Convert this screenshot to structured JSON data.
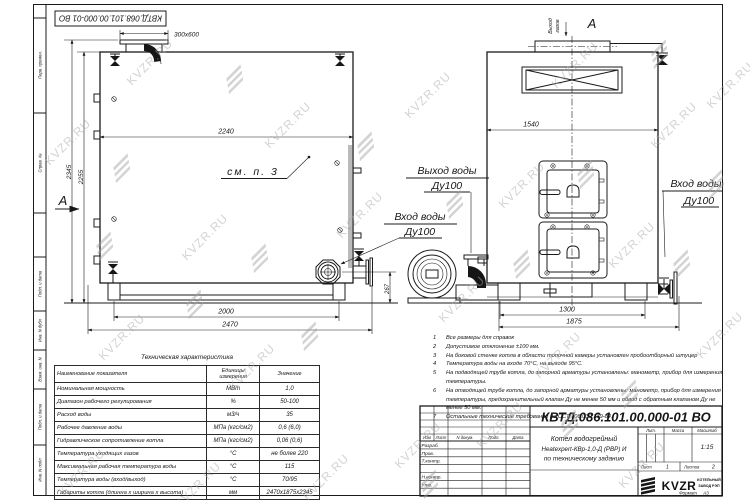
{
  "watermark": {
    "text": "KVZR.RU"
  },
  "stamp_top": "КВТД.068.101.00.000-01 ВО",
  "colors": {
    "line": "#1b1b1b",
    "watermark": "#a9a9a9"
  },
  "frame_labels": {
    "perv_primen": "Перв. примен.",
    "sprav_no": "Справ. №",
    "podp_data1": "Подп. и дата",
    "inv_dubl": "Инв. N дубл",
    "vzam_inv": "Взам. инв. N",
    "podp_data2": "Подп. и дата",
    "inv_podl": "Инв. N подл"
  },
  "side_view": {
    "chimney_size": "300x600",
    "dim_width_top": "2240",
    "dim_height_total": "2345",
    "dim_height_body": "2255",
    "dim_base": "2000",
    "dim_overall": "2470",
    "dim_flange_height": "267",
    "see_note": "см. п. 3",
    "section_mark": "А"
  },
  "front_view": {
    "dim_width": "1540",
    "dim_base": "1300",
    "dim_overall": "1875",
    "gas_out_word1": "Выход",
    "gas_out_word2": "газов",
    "view_mark": "А"
  },
  "labels": {
    "water_out": "Выход воды",
    "water_out_dn": "Ду100",
    "water_in_mid": "Вход воды",
    "water_in_mid_dn": "Ду100",
    "water_in_right": "Вход воды",
    "water_in_right_dn": "Ду100"
  },
  "tech_table": {
    "title": "Техническая характеристика",
    "headers": [
      "Наименование показателя",
      "Единицы измерения",
      "Значение"
    ],
    "rows": [
      [
        "Номинальная мощность",
        "МВт",
        "1,0"
      ],
      [
        "Диапазон рабочего регулирования",
        "%",
        "50-100"
      ],
      [
        "Расход воды",
        "м3/ч",
        "35"
      ],
      [
        "Рабочее давление воды",
        "МПа (кгс/см2)",
        "0,6 (6,0)"
      ],
      [
        "Гидравлическое сопротивление котла",
        "МПа (кгс/см2)",
        "0,06 (0,6)"
      ],
      [
        "Температура уходящих газов",
        "°С",
        "не более 220"
      ],
      [
        "Максимальная рабочая температура воды",
        "°С",
        "115"
      ],
      [
        "Температура воды (вход/выход)",
        "°С",
        "70/95"
      ],
      [
        "Габариты котла (длинна х ширина х высота)",
        "мм",
        "2470х1875х2345"
      ]
    ]
  },
  "notes": [
    {
      "n": "1",
      "text": "Все размеры для справок"
    },
    {
      "n": "2",
      "text": "Допустимое отклонение ±100 мм."
    },
    {
      "n": "3",
      "text": "На боковой стенке котла в области топочной камеры установлен пробоотборный штуцер"
    },
    {
      "n": "4",
      "text": "Температура воды на входе 70°С, на выходе 95°С."
    },
    {
      "n": "5",
      "text": "На  подводящей трубе котла, до запорной арматуры установлены: манометр, прибор для измерения температуры."
    },
    {
      "n": "6",
      "text": "На отводящей трубе котла, до запорной арматуры установлены: манометр, прибор для измерения температуры, предохранительный клапан Ду не менее 50 мм и обвод с обратным клапаном Ду не менее 50 мм."
    },
    {
      "n": "7",
      "text": "Остальные технические требования по ОСТ 108.030.139-84."
    }
  ],
  "title_block": {
    "doc_number": "КВТД.086.101.00.000-01 ВО",
    "title_line1": "Котел водогрейный",
    "title_line2": "Heatexpert-КВр-1,0-Д (РВР) И",
    "title_line3": "по техническому заданию",
    "header_cols": [
      "Изм",
      "Лист",
      "N докум.",
      "Подп.",
      "Дата"
    ],
    "rows": [
      "Разраб.",
      "Пров.",
      "Т.контр.",
      "Н.контр.",
      "Утв."
    ],
    "lit_label": "Лит.",
    "mass_label": "Масса",
    "scale_label": "Масштаб",
    "scale_value": "1:15",
    "sheet_label": "Лист",
    "sheet_value": "1",
    "sheets_label": "Листов",
    "sheets_value": "2",
    "logo_text": "KVZR",
    "org_line1": "КОТЕЛЬНЫЙ",
    "org_line2": "ЗАВОД РЭП",
    "format_label": "Формат",
    "format_value": "А3"
  }
}
